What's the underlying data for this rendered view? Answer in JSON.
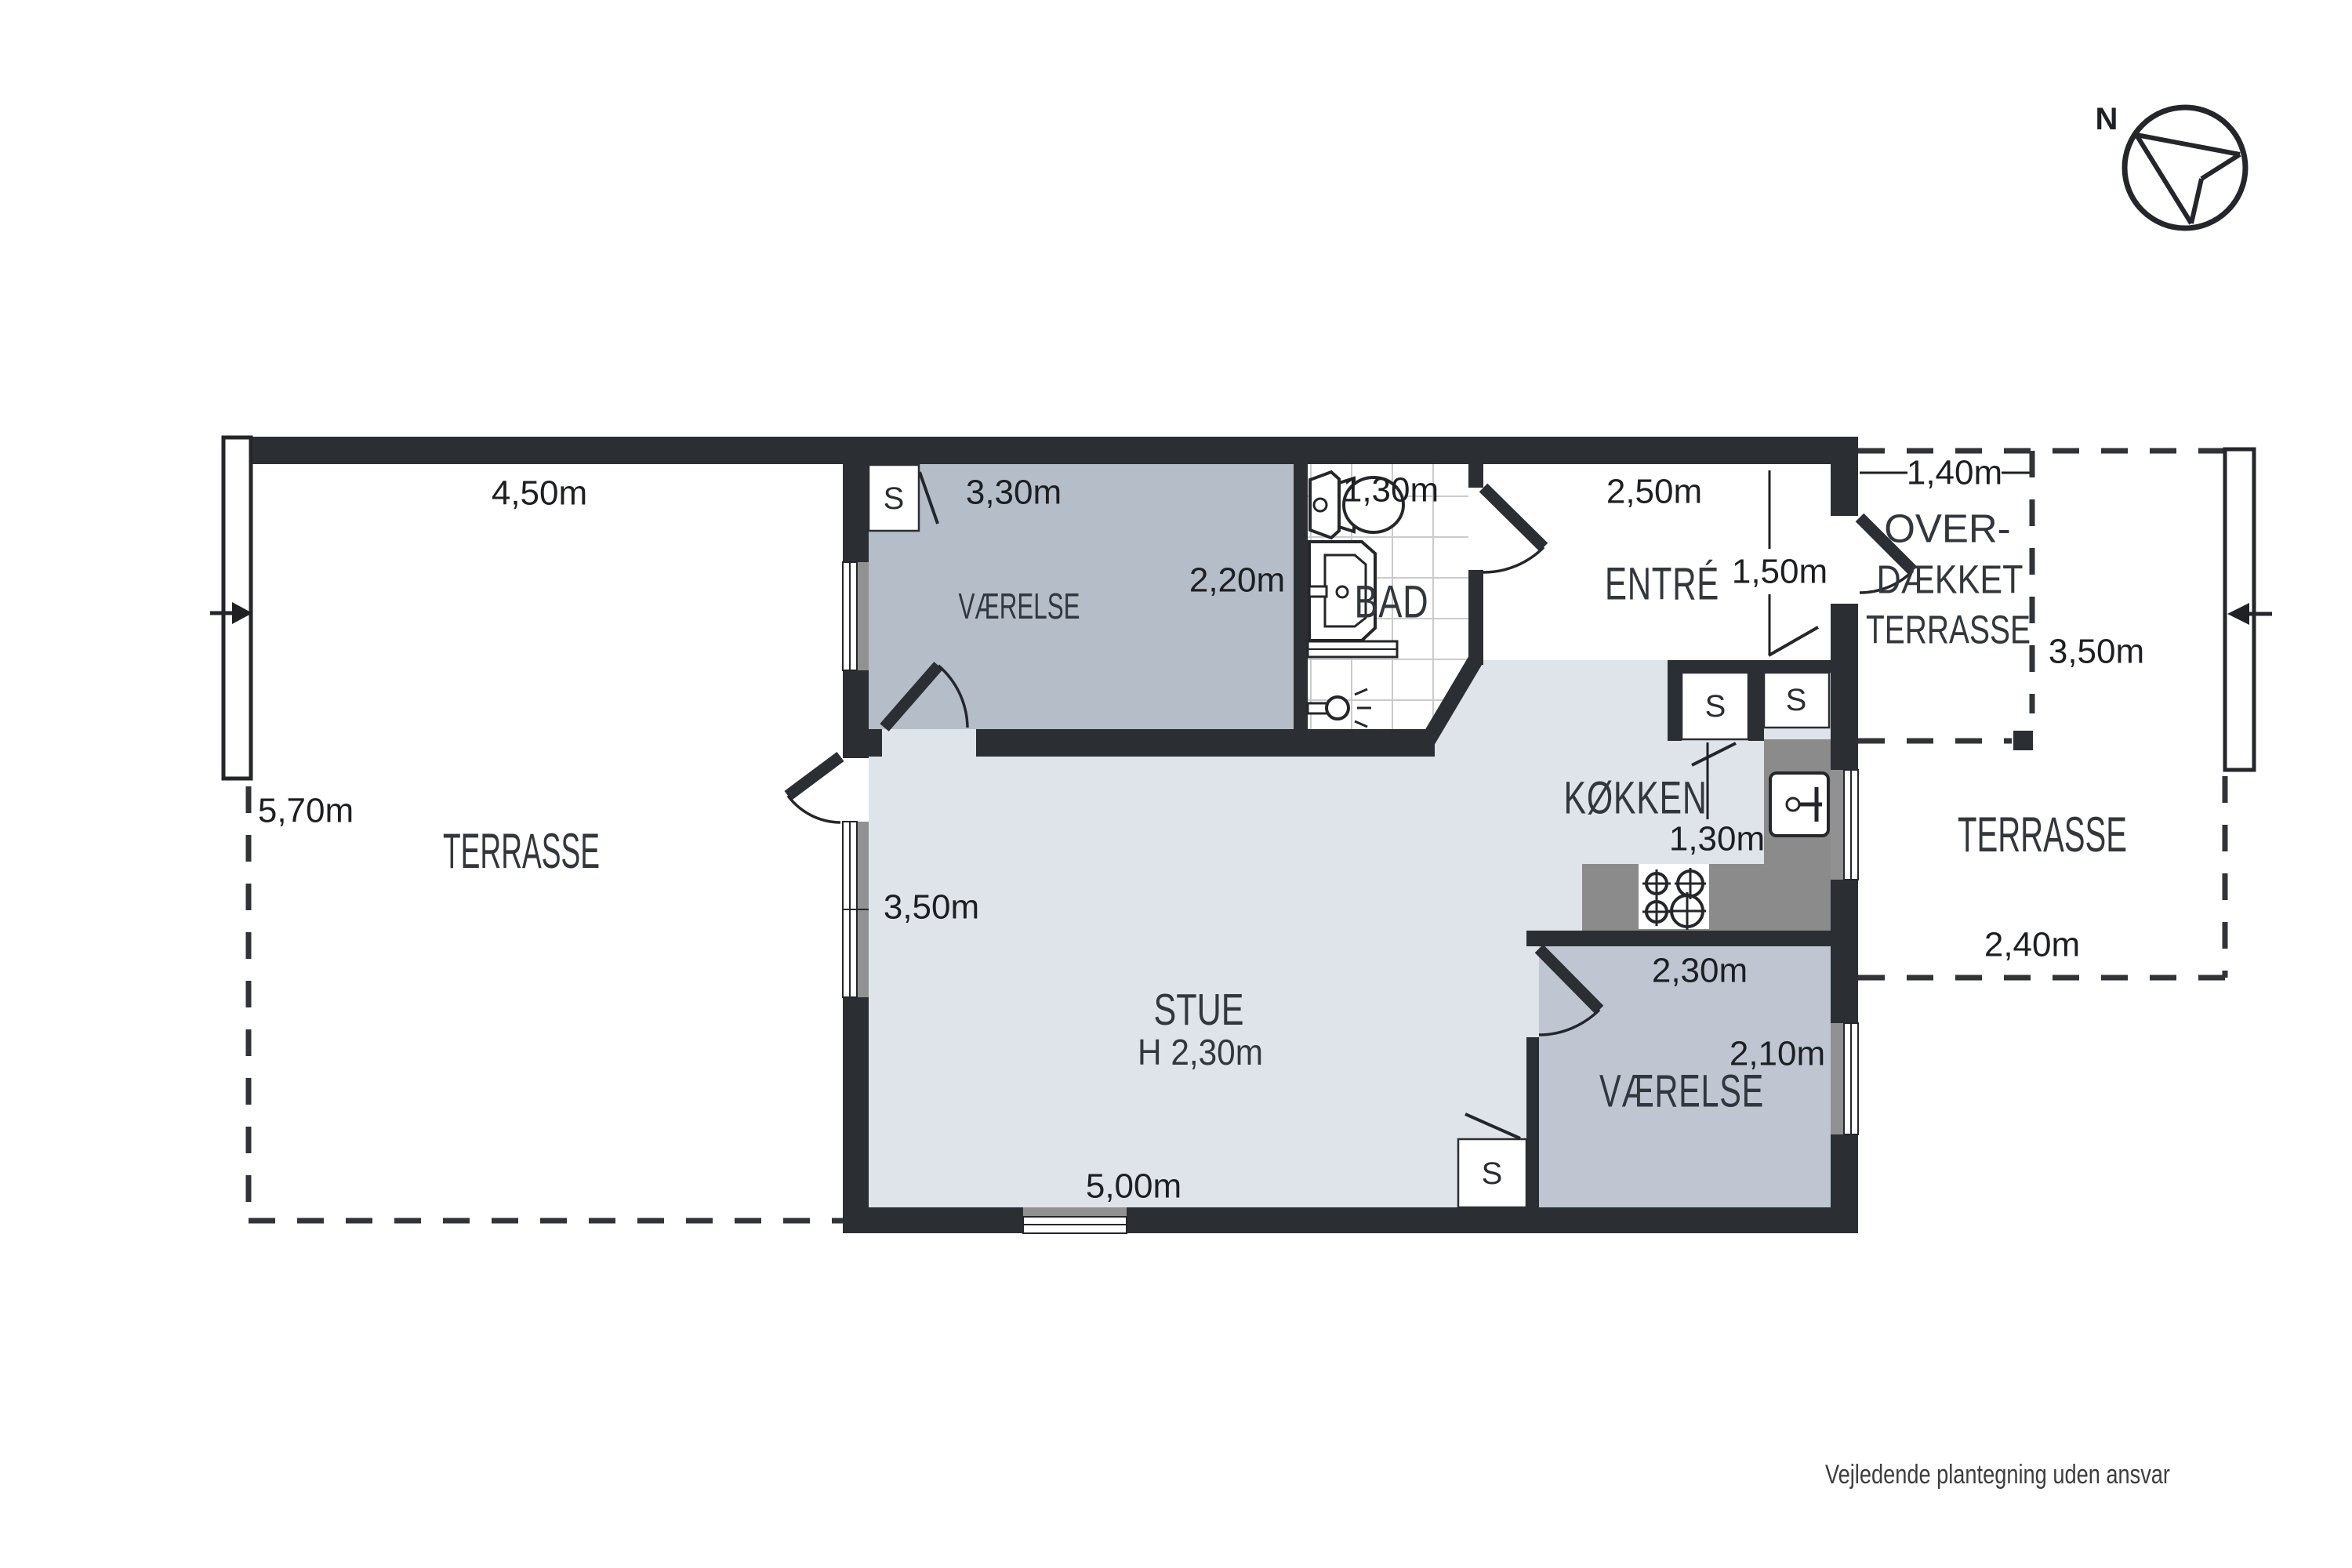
{
  "colors": {
    "wall": "#2b2e33",
    "floor-light": "#dee4ea",
    "room-gray": "#b5bdc9",
    "room-gray-2": "#bfc6d1",
    "counter-gray": "#8b8b8b",
    "sill-gray": "#919191",
    "tile-line": "#cbcbcb",
    "text-dark": "#1d1f22",
    "room-text": "#32373d"
  },
  "compass": {
    "north": "N"
  },
  "closet": {
    "label": "S"
  },
  "rooms": {
    "terrasse_left": {
      "name": "TERRASSE",
      "width": "4,50m",
      "depth": "5,70m"
    },
    "vaerelse_top": {
      "name": "VÆRELSE",
      "width": "3,30m",
      "depth": "2,20m"
    },
    "bad": {
      "name": "BAD",
      "width": "1,30m"
    },
    "entre": {
      "name": "ENTRÉ",
      "width": "2,50m",
      "depth": "1,50m"
    },
    "overdaekket_terrasse": {
      "name_line_1": "OVER-",
      "name_line_2": "DÆKKET",
      "name_line_3": "TERRASSE",
      "width": "1,40m",
      "depth": "3,50m"
    },
    "koekken": {
      "name": "KØKKEN",
      "width": "1,30m"
    },
    "stue": {
      "name": "STUE",
      "ceiling_height": "H 2,30m",
      "west_depth": "3,50m",
      "south_width": "5,00m"
    },
    "vaerelse_bottom": {
      "name": "VÆRELSE",
      "width": "2,30m",
      "depth": "2,10m"
    },
    "terrasse_right": {
      "name": "TERRASSE",
      "width": "2,40m"
    }
  },
  "footer": {
    "disclaimer": "Vejledende plantegning uden ansvar"
  }
}
